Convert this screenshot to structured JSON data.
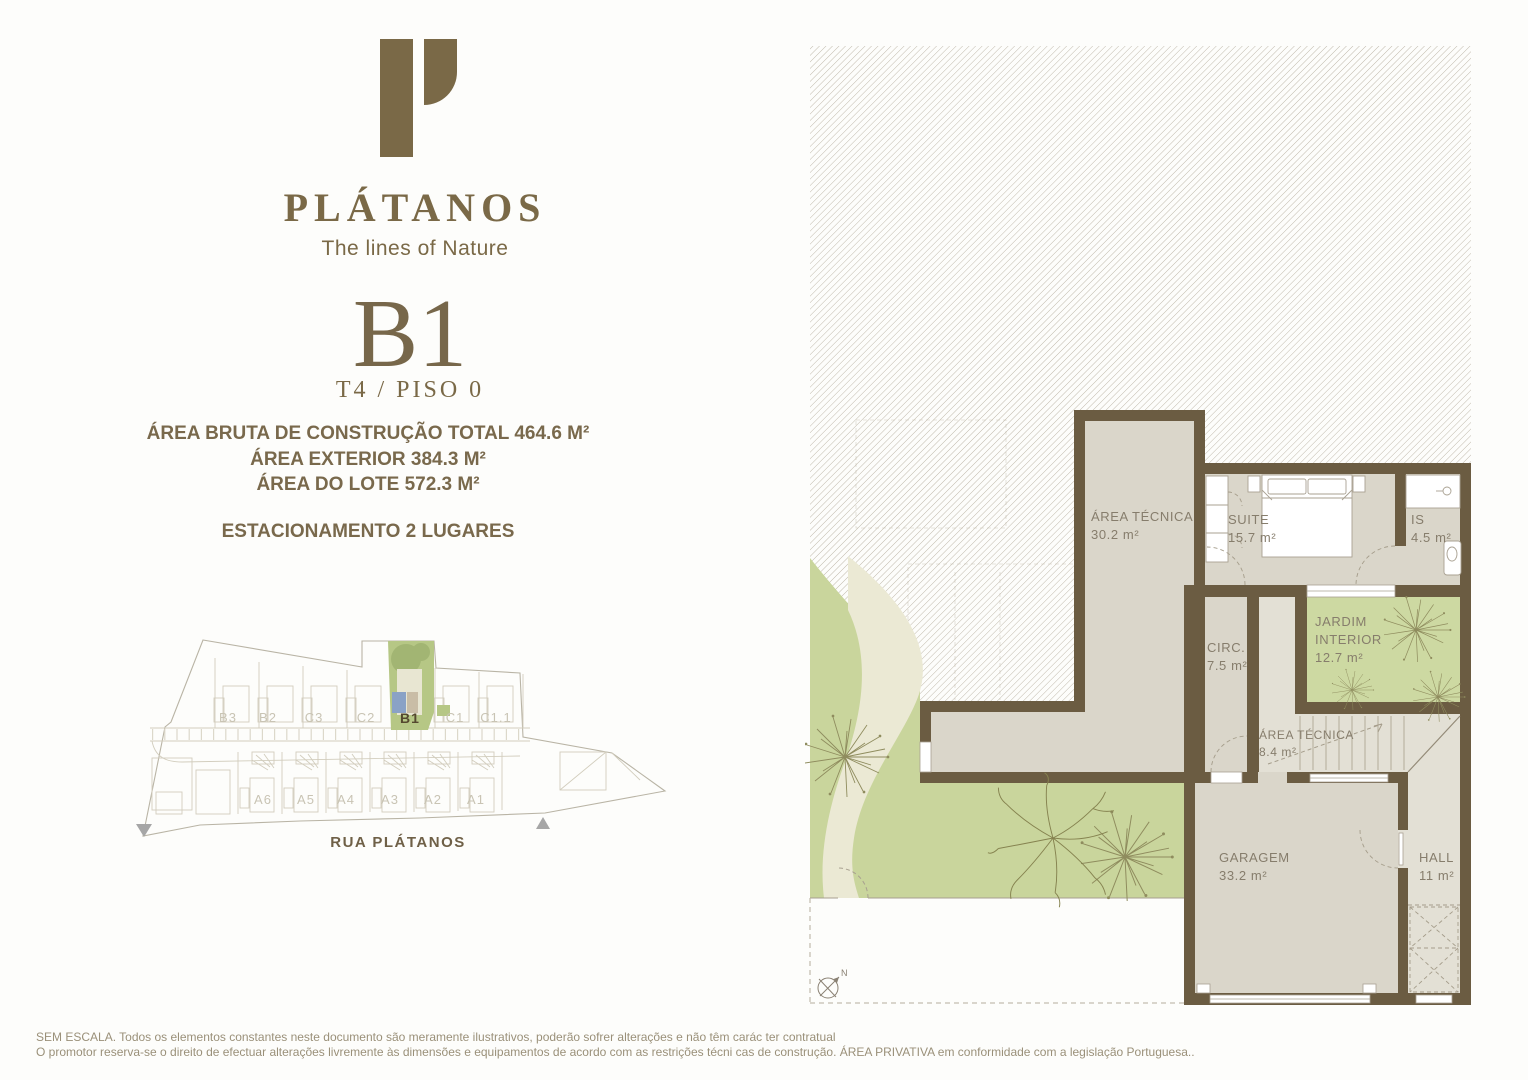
{
  "brand": {
    "name": "PLÁTANOS",
    "tagline": "The lines of Nature",
    "logo": "P-mark"
  },
  "unit": {
    "code": "B1",
    "subtitle": "T4 / PISO 0"
  },
  "specs": {
    "area_bruta": "ÁREA BRUTA DE CONSTRUÇÃO TOTAL 464.6 M²",
    "area_exterior": "ÁREA EXTERIOR 384.3 M²",
    "area_lote": "ÁREA DO LOTE 572.3 M²",
    "estacionamento": "ESTACIONAMENTO 2 LUGARES"
  },
  "site_plan": {
    "street": "RUA PLÁTANOS",
    "top_row": [
      "B3",
      "B2",
      "C3",
      "C2",
      "B1",
      "C1",
      "C1.1"
    ],
    "bottom_row": [
      "A6",
      "A5",
      "A4",
      "A3",
      "A2",
      "A1"
    ],
    "highlighted_unit": "B1"
  },
  "floor_plan": {
    "rooms": {
      "area_tecnica_1": {
        "name": "ÁREA TÉCNICA",
        "area": "30.2 m²"
      },
      "suite": {
        "name": "SUITE",
        "area": "15.7 m²"
      },
      "is": {
        "name": "IS",
        "area": "4.5 m²"
      },
      "circ": {
        "name": "CIRC.",
        "area": "7.5 m²"
      },
      "jardim": {
        "name_line1": "JARDIM",
        "name_line2": "INTERIOR",
        "area": "12.7 m²"
      },
      "area_tecnica_2": {
        "name": "ÁREA TÉCNICA",
        "area": "8.4 m²"
      },
      "garagem": {
        "name": "GARAGEM",
        "area": "33.2 m²"
      },
      "hall": {
        "name": "HALL",
        "area": "11 m²"
      }
    },
    "compass_label": "N"
  },
  "footer": {
    "line1": "SEM ESCALA. Todos os elementos constantes neste documento são meramente ilustrativos, poderão sofrer alterações e não têm carác ter contratual",
    "line2": "O promotor reserva-se o direito de efectuar alterações livremente às dimensões e equipamentos de acordo com as restrições técni cas de construção. ÁREA PRIVATIVA em conformidade com a legislação Portuguesa.."
  },
  "colors": {
    "brand": "#7a6947",
    "wall": "#6b5c42",
    "garden_green": "#c9d59c",
    "jardim_green": "#cdd9a2",
    "highlight_green": "#b6c785",
    "highlight_blue": "#8aa2c6"
  }
}
